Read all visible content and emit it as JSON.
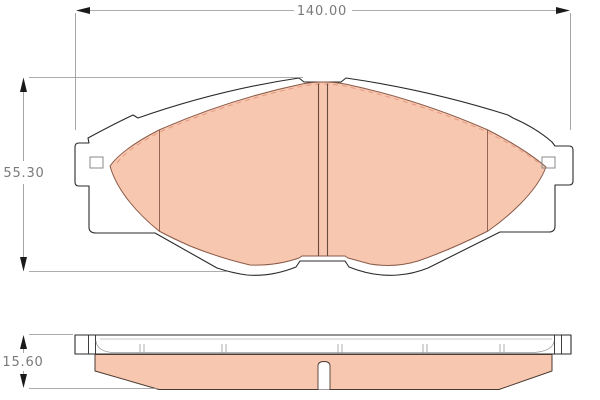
{
  "drawing": {
    "type": "brake-pad-technical-drawing",
    "dimensions": {
      "width": "140.00",
      "height": "55.30",
      "thickness": "15.60"
    }
  },
  "colors": {
    "background": "#ffffff",
    "friction_fill": "#f8c7b0",
    "outline": "#2a2a2a",
    "friction_stroke": "#8a5a48",
    "chamfer_dashed": "#e39b82",
    "dimension_line": "#909090",
    "dimension_text": "#7a7a7a",
    "arrow": "#1a1a1a"
  }
}
